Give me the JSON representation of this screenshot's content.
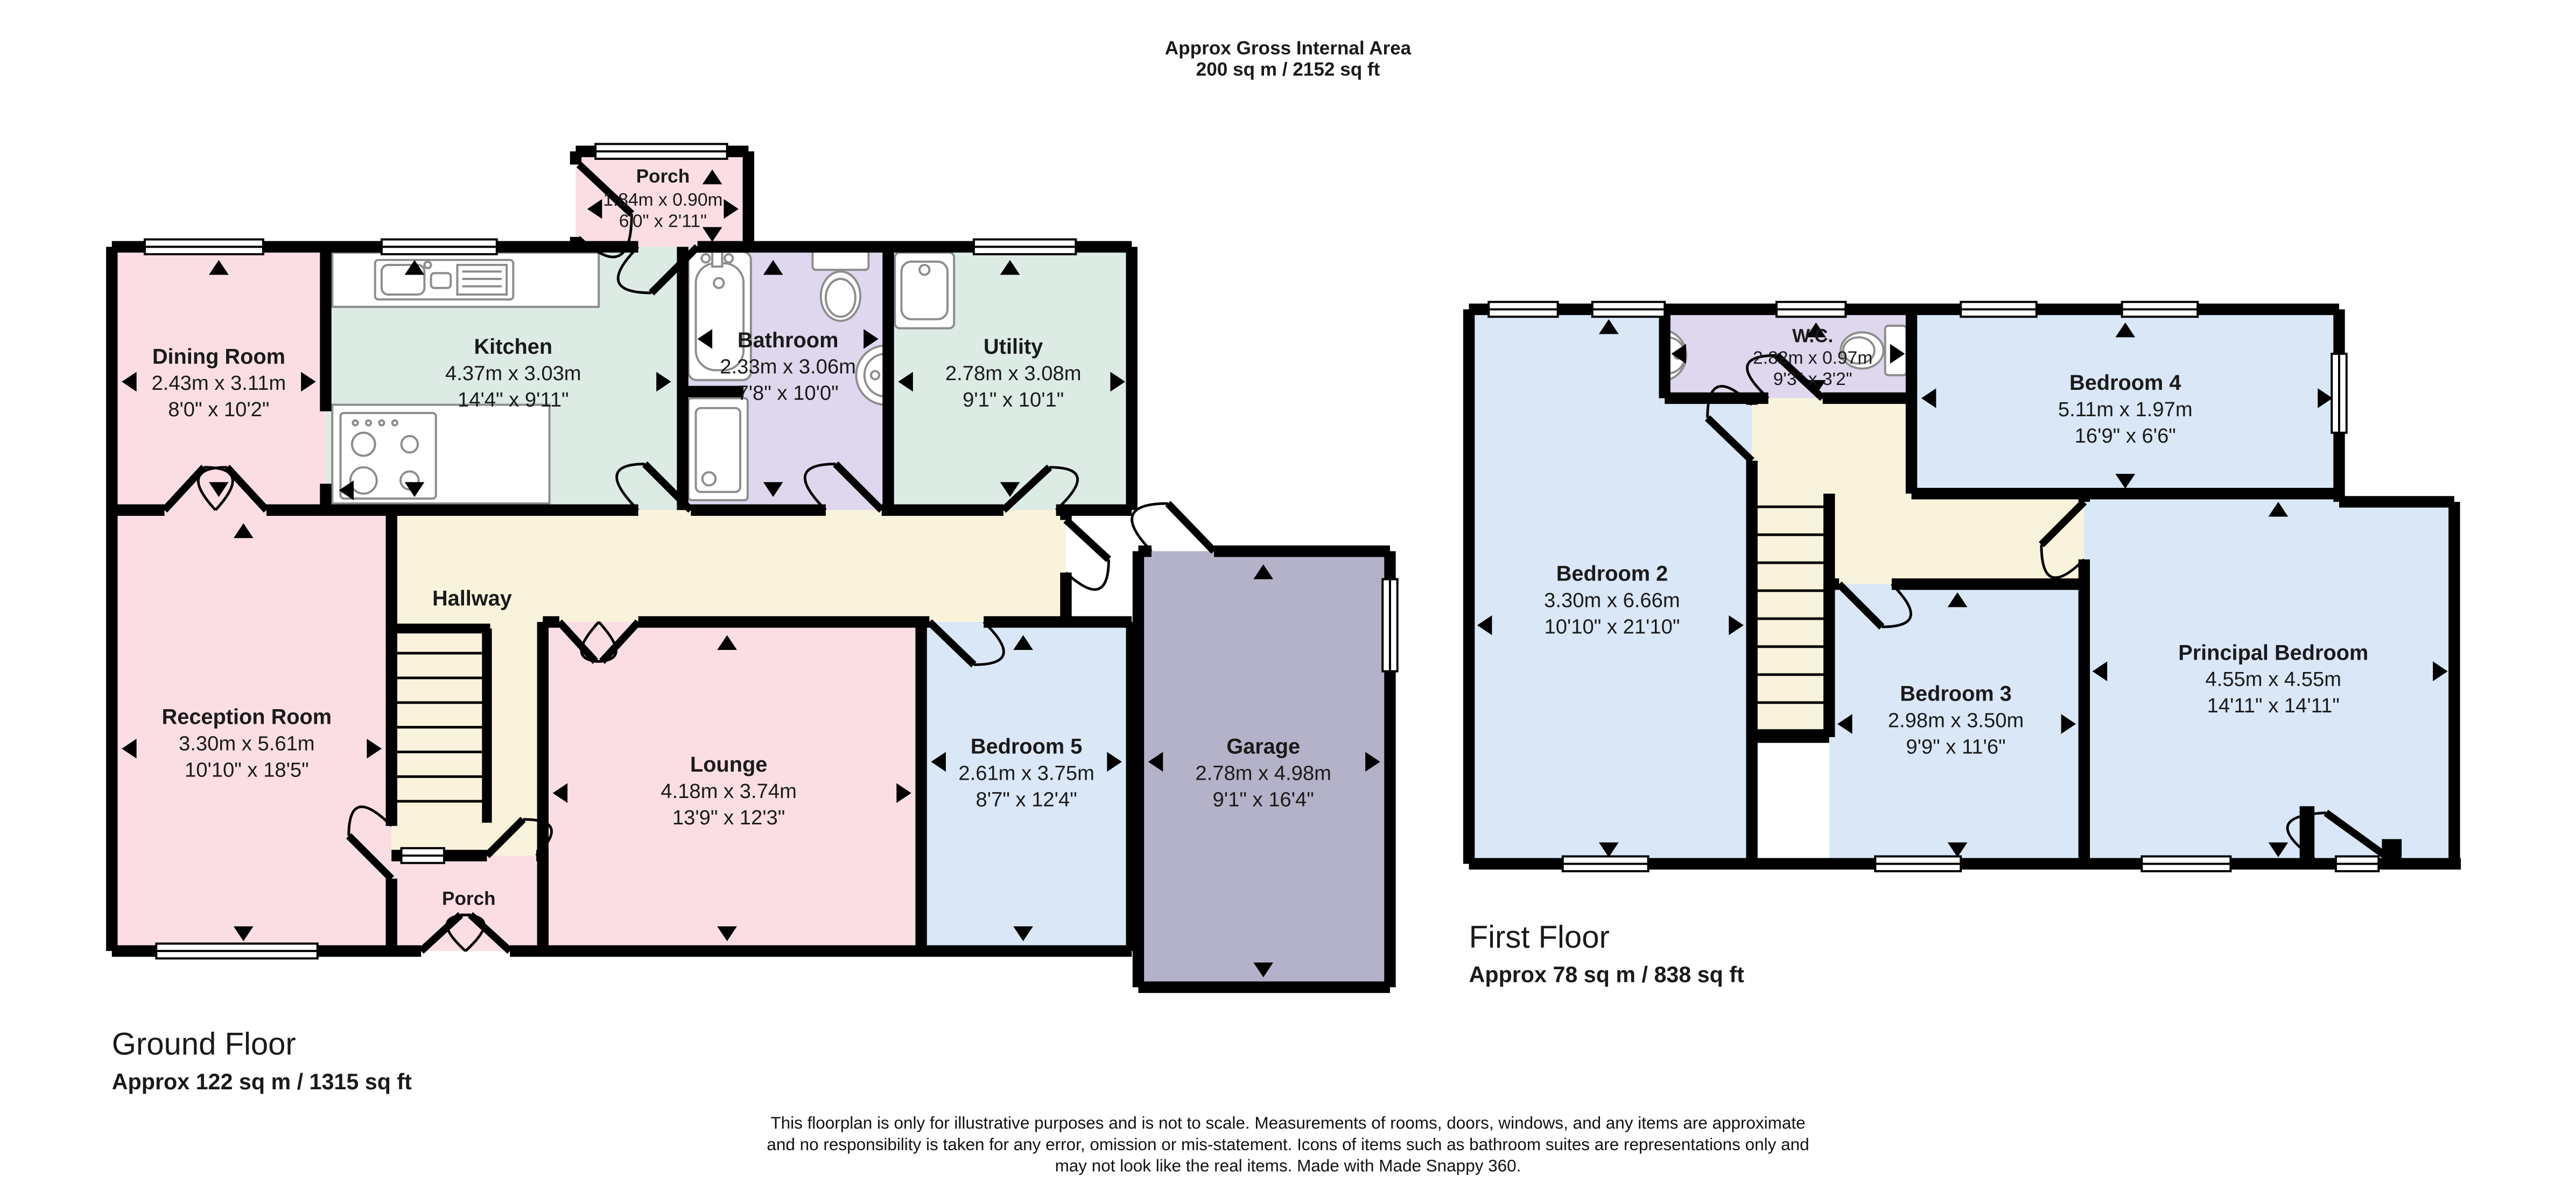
{
  "title": {
    "line1": "Approx Gross Internal Area",
    "line2": "200 sq m / 2152 sq ft"
  },
  "ground_floor": {
    "label": "Ground Floor",
    "area": "Approx 122 sq m / 1315 sq ft",
    "rooms": {
      "porch_top": {
        "name": "Porch",
        "metric": "1.84m x 0.90m",
        "imperial": "6'0\" x 2'11\""
      },
      "dining_room": {
        "name": "Dining Room",
        "metric": "2.43m x 3.11m",
        "imperial": "8'0\" x 10'2\""
      },
      "kitchen": {
        "name": "Kitchen",
        "metric": "4.37m x 3.03m",
        "imperial": "14'4\" x 9'11\""
      },
      "bathroom": {
        "name": "Bathroom",
        "metric": "2.33m x 3.06m",
        "imperial": "7'8\" x 10'0\""
      },
      "utility": {
        "name": "Utility",
        "metric": "2.78m x 3.08m",
        "imperial": "9'1\" x 10'1\""
      },
      "hallway": {
        "name": "Hallway"
      },
      "reception_room": {
        "name": "Reception Room",
        "metric": "3.30m x 5.61m",
        "imperial": "10'10\" x 18'5\""
      },
      "lounge": {
        "name": "Lounge",
        "metric": "4.18m x 3.74m",
        "imperial": "13'9\" x 12'3\""
      },
      "porch_bottom": {
        "name": "Porch"
      },
      "bedroom_5": {
        "name": "Bedroom 5",
        "metric": "2.61m x 3.75m",
        "imperial": "8'7\" x 12'4\""
      },
      "garage": {
        "name": "Garage",
        "metric": "2.78m x 4.98m",
        "imperial": "9'1\" x 16'4\""
      }
    }
  },
  "first_floor": {
    "label": "First Floor",
    "area": "Approx 78 sq m / 838 sq ft",
    "rooms": {
      "wc": {
        "name": "W.C.",
        "metric": "2.82m x 0.97m",
        "imperial": "9'3\" x 3'2\""
      },
      "bedroom_4": {
        "name": "Bedroom 4",
        "metric": "5.11m x 1.97m",
        "imperial": "16'9\" x 6'6\""
      },
      "bedroom_2": {
        "name": "Bedroom 2",
        "metric": "3.30m x 6.66m",
        "imperial": "10'10\" x 21'10\""
      },
      "bedroom_3": {
        "name": "Bedroom 3",
        "metric": "2.98m x 3.50m",
        "imperial": "9'9\" x 11'6\""
      },
      "principal_bedroom": {
        "name": "Principal Bedroom",
        "metric": "4.55m x 4.55m",
        "imperial": "14'11\" x 14'11\""
      }
    }
  },
  "footer": {
    "line1": "This floorplan is only for illustrative purposes and is not to scale. Measurements of rooms, doors, windows, and any items are approximate",
    "line2": "and no responsibility is taken for any error, omission or mis-statement. Icons of items such as bathroom suites are representations only and",
    "line3": "may not look like the real items. Made with Made Snappy 360."
  },
  "colors": {
    "pink": "#fadee4",
    "mint": "#dcebe3",
    "lavender": "#ded7ee",
    "cream": "#faf3dc",
    "blue": "#d9e7f6",
    "garage": "#b4b2c8",
    "wall": "#000000",
    "fixture": "#8d8d8d"
  }
}
